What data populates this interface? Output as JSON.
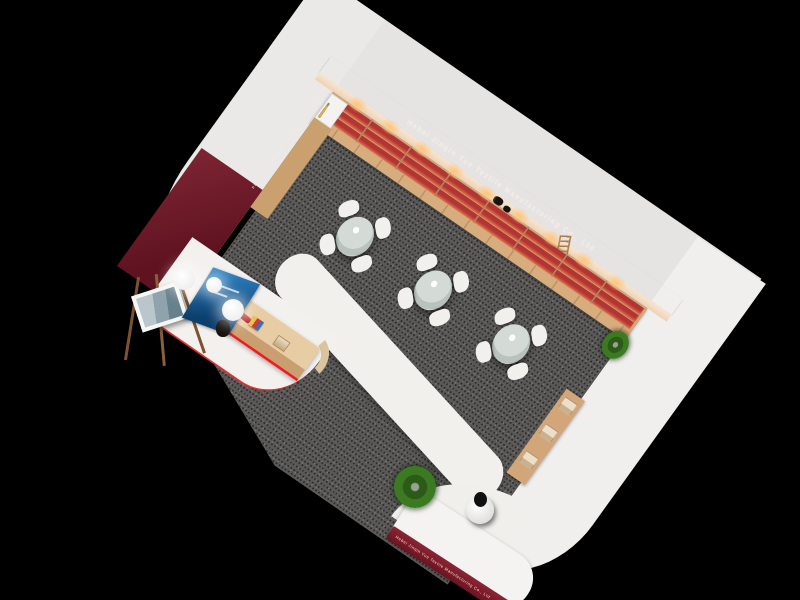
{
  "scene": {
    "description": "Bird's-eye 3D rendering of a textile company showroom",
    "background_color": "#000000"
  },
  "branding": {
    "company_name": "Hebei Jinqin Yue Textile Manufacturing Co., Ltd",
    "banner_color": "#7a202c",
    "banner_text_color": "#f3eae4"
  },
  "display_wall": {
    "shelf_rows": 3,
    "products_per_row": 26,
    "bays": 7,
    "under_shelf_lights": 9,
    "product_base_color": "#efece8",
    "product_accent_color": "#c4423a",
    "back_panel_color": "#b23434",
    "wood_color": "#d2a678"
  },
  "swatch_wall": {
    "rows_per_column": 4,
    "column_colors": [
      "#ece287",
      "#e9c3d0",
      "#c3dff0",
      "#abdcd3",
      "#ece287",
      "#e9c3d0",
      "#c3dff0",
      "#e8e4cf"
    ]
  },
  "corner_bookshelf": {
    "spine_colors": [
      "#4a6fa5",
      "#c05a5a",
      "#7a9b68",
      "#2e2e2e",
      "#d8b24a"
    ]
  },
  "seating_area": {
    "tables": 3,
    "chairs_per_table": 4,
    "table_top_color": "#ccd3cd",
    "chair_color": "#f1f0ed",
    "carpet_color": "#5a5957"
  },
  "reception": {
    "accent_wall_color": "#6f1b28",
    "pendant_lamps": 3,
    "desk_wood_color": "#e8cda4",
    "poster_color": "#1f6fb5",
    "easel_artwork": "framed print",
    "desk_products": [
      "red fabric rolls",
      "striped sample box",
      "kraft box"
    ],
    "trim_color": "#ee1c1c"
  },
  "entrance": {
    "counter_text": "Hebei Jinqin Yue Textile Manufacturing Co., Ltd",
    "visitors": 1,
    "floor_plants": 2,
    "bench_boxes": 3
  }
}
